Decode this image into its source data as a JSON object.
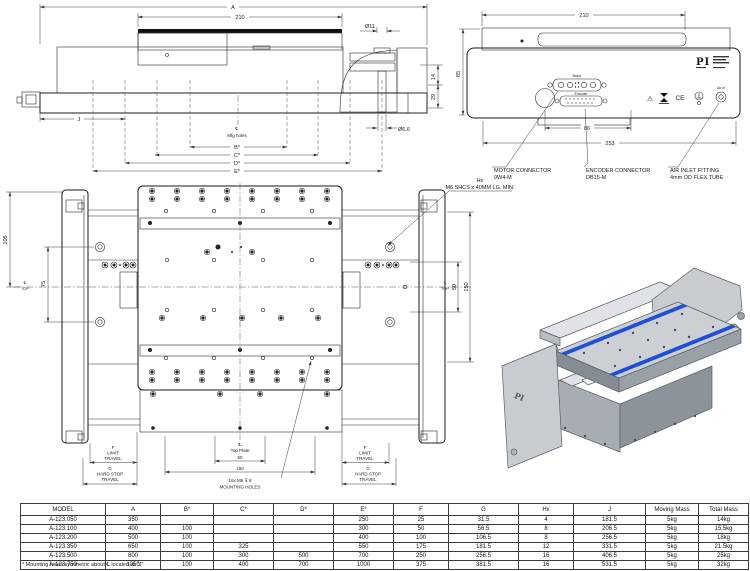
{
  "side_view": {
    "dim_a": "A",
    "dim_210": "210",
    "dia_top": "Ø11",
    "dim_14": "14",
    "dim_29": "29",
    "dia_bottom": "Ø6.6",
    "dim_j": "J",
    "cl": "℄",
    "mfg_holes": "Mfg holes",
    "dim_b": "B*",
    "dim_c": "C*",
    "dim_d": "D*",
    "dim_e": "E*"
  },
  "front_view": {
    "dim_210": "210",
    "dim_85": "85",
    "dim_86": "86",
    "dim_253": "253",
    "port_motor": "Motor",
    "port_encoder": "Encoder",
    "logo": "PI",
    "ce": "CE",
    "warning": "⚠",
    "air_in": "Air In",
    "callout_motor_1": "MOTOR CONNECTOR",
    "callout_motor_2": "9W4-M",
    "callout_encoder_1": "ENCODER CONNECTOR",
    "callout_encoder_2": "DB15-M",
    "callout_air_1": "AIR INLET FITTING",
    "callout_air_2": "4mm OD FLEX TUBE"
  },
  "top_view": {
    "dim_105": "105",
    "dim_75": "75",
    "dim_50_side": "50",
    "dim_150_side": "150",
    "cl": "℄",
    "top": "TOP",
    "screw_note_1": "Hx",
    "screw_note_2": "M6 SHCS x 40MM LG. MIN.",
    "plate_cl_1": "℄",
    "plate_cl_2": "Top Plate",
    "dim_50": "50",
    "dim_150": "150",
    "mounting_note_1": "16x M6 ⊽ 8",
    "mounting_note_2": "MOUNTING HOLES",
    "f": "F",
    "limit": "LIMIT",
    "travel": "TRAVEL",
    "g": "G",
    "hard_stop": "HARD STOP"
  },
  "iso": {
    "logo": "PI"
  },
  "table": {
    "headers": [
      "MODEL",
      "A",
      "B*",
      "C*",
      "D*",
      "E*",
      "F",
      "G",
      "Hx",
      "J",
      "Moving Mass",
      "Total Mass"
    ],
    "rows": [
      [
        "A-123.050",
        "350",
        "",
        "",
        "",
        "250",
        "25",
        "31.5",
        "4",
        "181.5",
        "5kg",
        "14kg"
      ],
      [
        "A-123.100",
        "400",
        "100",
        "",
        "",
        "300",
        "50",
        "56.5",
        "8",
        "206.5",
        "5kg",
        "15.5kg"
      ],
      [
        "A-123.200",
        "500",
        "100",
        "",
        "",
        "400",
        "100",
        "106.5",
        "8",
        "256.5",
        "5kg",
        "18kg"
      ],
      [
        "A-123.350",
        "650",
        "100",
        "325",
        "",
        "550",
        "175",
        "181.5",
        "12",
        "331.5",
        "5kg",
        "21.5kg"
      ],
      [
        "A-123.500",
        "800",
        "100",
        "300",
        "500",
        "700",
        "250",
        "256.5",
        "16",
        "406.5",
        "5kg",
        "25kg"
      ],
      [
        "A-123.750",
        "1050",
        "100",
        "400",
        "700",
        "1000",
        "375",
        "381.5",
        "16",
        "531.5",
        "5kg",
        "32kg"
      ]
    ]
  },
  "footnote": "* Mounting holes symmetric about ℄ located at \"J\""
}
